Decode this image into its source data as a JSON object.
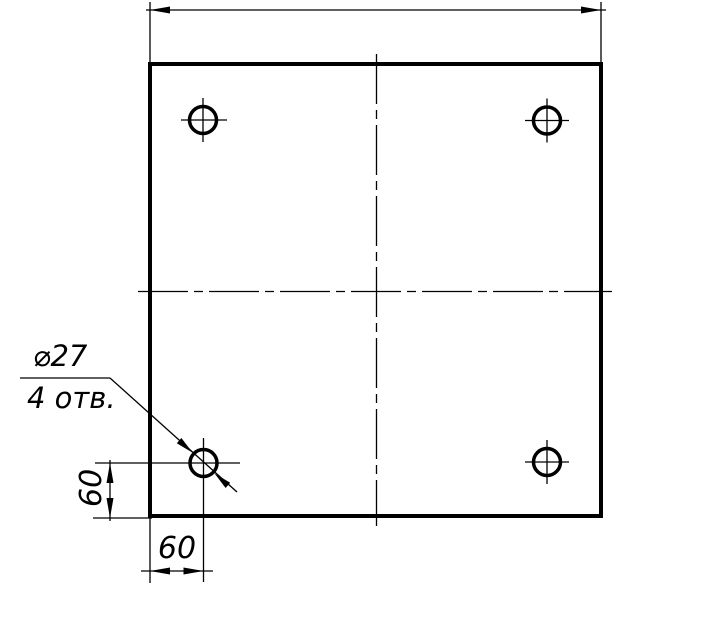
{
  "drawing": {
    "colors": {
      "line": "#000000",
      "background": "#ffffff"
    },
    "leader": {
      "diameter_label": "⌀27",
      "holes_note": "4 отв."
    },
    "dimensions": {
      "horizontal_offset": "60",
      "vertical_offset": "60"
    }
  }
}
